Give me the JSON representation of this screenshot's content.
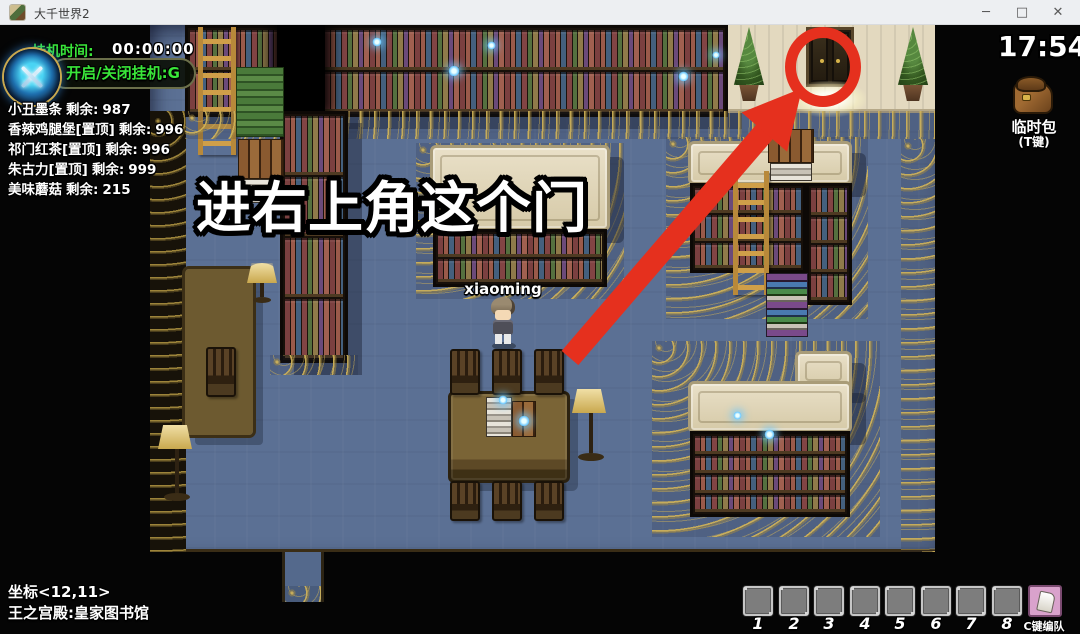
{
  "window": {
    "title": "大千世界2",
    "controls": {
      "minimize": "─",
      "maximize": "□",
      "close": "✕"
    }
  },
  "hud": {
    "idle": {
      "label": "挂机时间:",
      "time": "00:00:00",
      "toggle_label": "开启/关闭挂机:G"
    },
    "supplies": [
      {
        "name": "小丑墨条",
        "label": "剩余:",
        "count": "987"
      },
      {
        "name": "香辣鸡腿堡[置顶]",
        "label": "剩余:",
        "count": "996"
      },
      {
        "name": "祁门红茶[置顶]",
        "label": "剩余:",
        "count": "996"
      },
      {
        "name": "朱古力[置顶]",
        "label": "剩余:",
        "count": "999"
      },
      {
        "name": "美味蘑菇",
        "label": "剩余:",
        "count": "215"
      }
    ],
    "clock": "17:54",
    "temp_bag": {
      "label": "临时包",
      "hotkey": "(T键)"
    },
    "status": {
      "coords": "坐标<12,11>",
      "location": "王之宫殿:皇家图书馆"
    },
    "hotbar": {
      "slots": [
        "1",
        "2",
        "3",
        "4",
        "5",
        "6",
        "7",
        "8"
      ],
      "team_label": "C键编队"
    }
  },
  "scene": {
    "instruction": "进右上角这个门",
    "player_name": "xiaoming"
  },
  "colors": {
    "accent_green": "#39e639",
    "annotation_red": "#e5301e",
    "floor_blue": "#5b7094",
    "trim_gold": "#bc9e46",
    "wall_cream": "#e3d9bf",
    "slot_gray": "#7d7d7d",
    "team_icon_pink": "#d9a2cc"
  }
}
